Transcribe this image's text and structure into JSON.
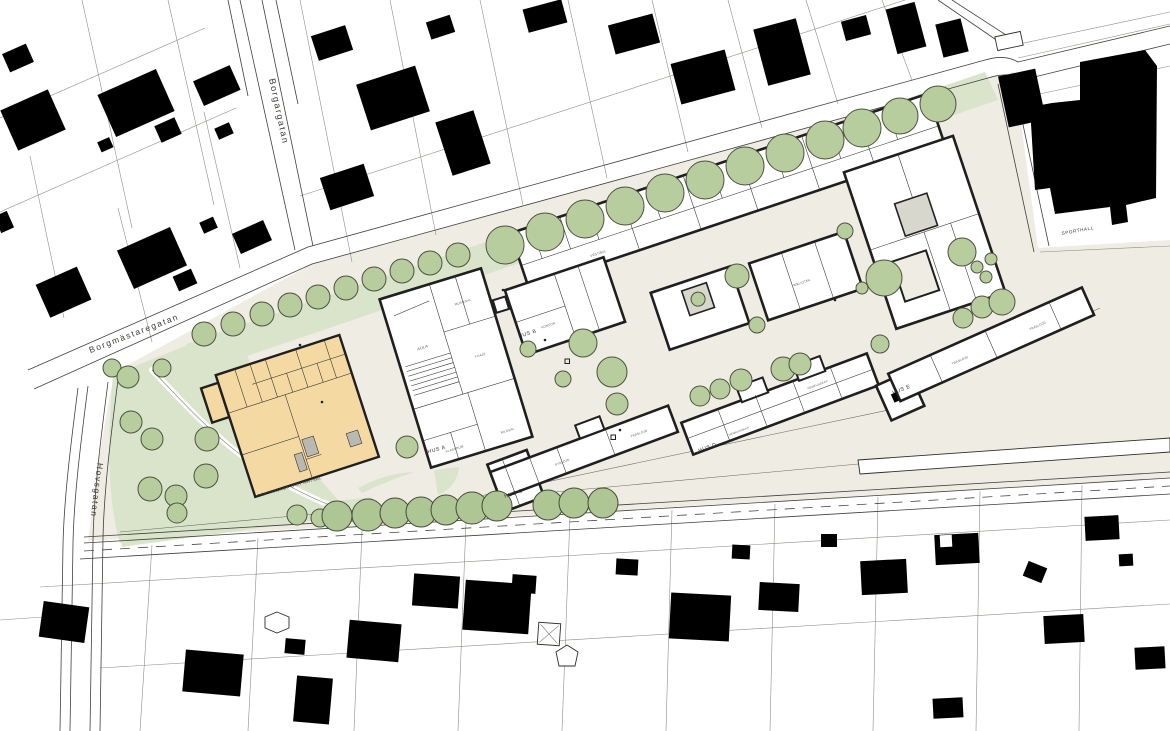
{
  "streets": {
    "borgargatan": "Borgargatan",
    "borgmastaregatan": "Borgmästaregatan",
    "hovsgatan": "Hovsgatan"
  },
  "buildings": {
    "hus_a": "HUS A",
    "hus_b": "HUS B",
    "hus_c": "HUS C",
    "hus_d": "HUS D",
    "hus_e": "HUS E",
    "sporthall": "SPORTHALL",
    "centralkok": "CENTRALKÖK OCH MATSAL"
  },
  "rooms": {
    "aula": "AULA",
    "foaje": "FOAJÉ",
    "musiksal": "MUSIKSAL",
    "klassrum": "KLASSRUM",
    "bildsal": "BILDSAL",
    "vestibul": "VESTIBUL",
    "cafe": "CAFÉ",
    "kontor": "KONTOR",
    "bibliotek": "BIBLIOTEK",
    "syslojd": "SYSLÖJD",
    "traslojd": "TRÄSLÖJD",
    "hemkunskap": "HEMKUNSKAP"
  },
  "colors": {
    "ground": "#EFECE3",
    "green": "#D9E4CB",
    "tree": "#B7CD9E",
    "tree_dark": "#AEC693",
    "outline": "#1F1F1F",
    "house": "#000000",
    "orange": "#F5D9A2"
  }
}
